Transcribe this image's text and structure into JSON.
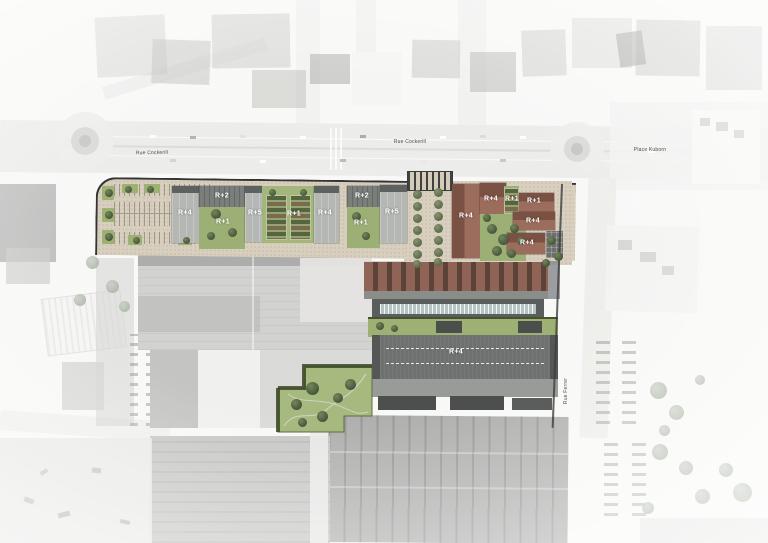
{
  "streets": {
    "west_boulevard": "Rue Cockerill",
    "east_boulevard": "Rue Cockerill",
    "square": "Place Kuborn",
    "side_street": "Rue Ferrer"
  },
  "building_labels": {
    "b01": "R+4",
    "b02": "R+2",
    "b03": "R+1",
    "b04": "R+5",
    "b05": "R+1",
    "b06": "R+4",
    "b07": "R+2",
    "b08": "R+1",
    "b09": "R+5",
    "b10": "R+4",
    "b11": "R+4",
    "b12": "R+1",
    "b13": "R+1",
    "b14": "R+4",
    "b15": "R+4",
    "b16": "R+4"
  },
  "colors": {
    "paving": "#d8cfbf",
    "lawn": "#9cb076",
    "new_slab_building": "#b5b7b4",
    "slab_roof_edge": "#5d615f",
    "brick_roof": "#9c6c5d",
    "brick_roof_shadow": "#7a5143",
    "dark_industrial_roof": "#595d5b",
    "park_green": "#a6b97f",
    "label_text": "#ffffff",
    "site_boundary": "#343434"
  }
}
